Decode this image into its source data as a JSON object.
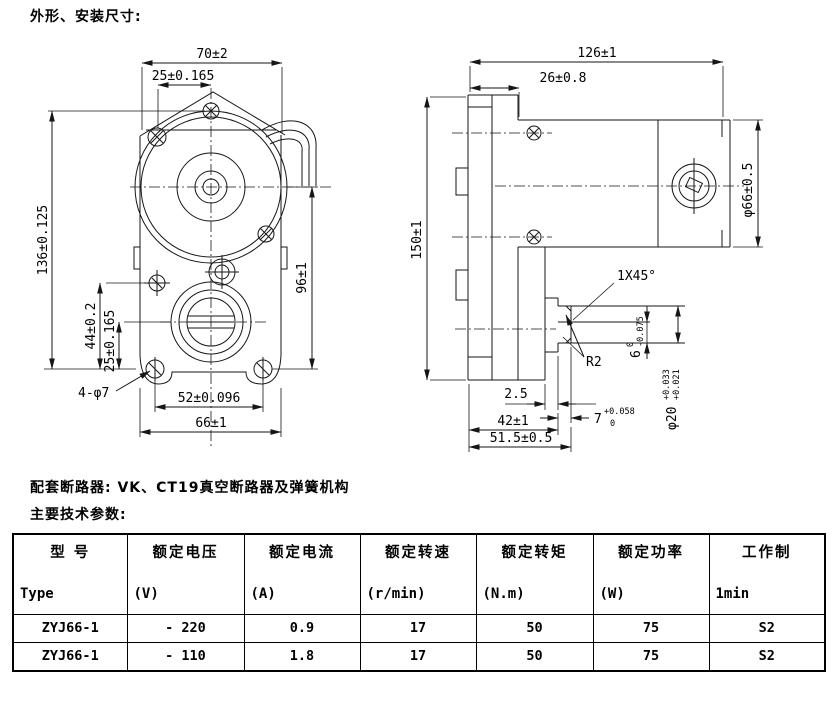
{
  "texts": {
    "title": "外形、安装尺寸:",
    "breaker_note": "配套断路器: VK、CT19真空断路器及弹簧机构",
    "params_label": "主要技术参数:"
  },
  "front_view": {
    "dim_width_top": "70±2",
    "dim_hole_pitch_top": "25±0.165",
    "dim_height_overall": "136±0.125",
    "dim_height_right": "96±1",
    "dim_pitch_44": "44±0.2",
    "dim_pitch_25_bottom": "25±0.165",
    "label_mount_holes": "4-φ7",
    "dim_hole_pitch_bottom": "52±0.096",
    "dim_width_bottom": "66±1"
  },
  "side_view": {
    "dim_length_overall": "126±1",
    "dim_flange_thickness": "26±0.8",
    "dim_height_overall": "150±1",
    "dim_body_diameter": "φ66±0.5",
    "label_chamfer": "1X45°",
    "label_fillet": "R2",
    "dim_step": "2.5",
    "dim_key_height": "6",
    "dim_key_height_tol_upper": "0",
    "dim_key_height_tol_lower": "-0.075",
    "dim_key_width": "7",
    "dim_key_width_tol_upper": "+0.058",
    "dim_key_width_tol_lower": "0",
    "dim_shaft_diameter": "φ20",
    "dim_shaft_tol_upper": "+0.033",
    "dim_shaft_tol_lower": "+0.021",
    "dim_shaft_length": "42±1",
    "dim_total_length": "51.5±0.5"
  },
  "table": {
    "headers": [
      {
        "cn": "型 号",
        "en": "Type"
      },
      {
        "cn": "额定电压",
        "en": "(V)"
      },
      {
        "cn": "额定电流",
        "en": "(A)"
      },
      {
        "cn": "额定转速",
        "en": "(r/min)"
      },
      {
        "cn": "额定转矩",
        "en": "(N.m)"
      },
      {
        "cn": "额定功率",
        "en": "(W)"
      },
      {
        "cn": "工作制",
        "en": "1min"
      }
    ],
    "rows": [
      [
        "ZYJ66-1",
        "- 220",
        "0.9",
        "17",
        "50",
        "75",
        "S2"
      ],
      [
        "ZYJ66-1",
        "- 110",
        "1.8",
        "17",
        "50",
        "75",
        "S2"
      ]
    ]
  }
}
